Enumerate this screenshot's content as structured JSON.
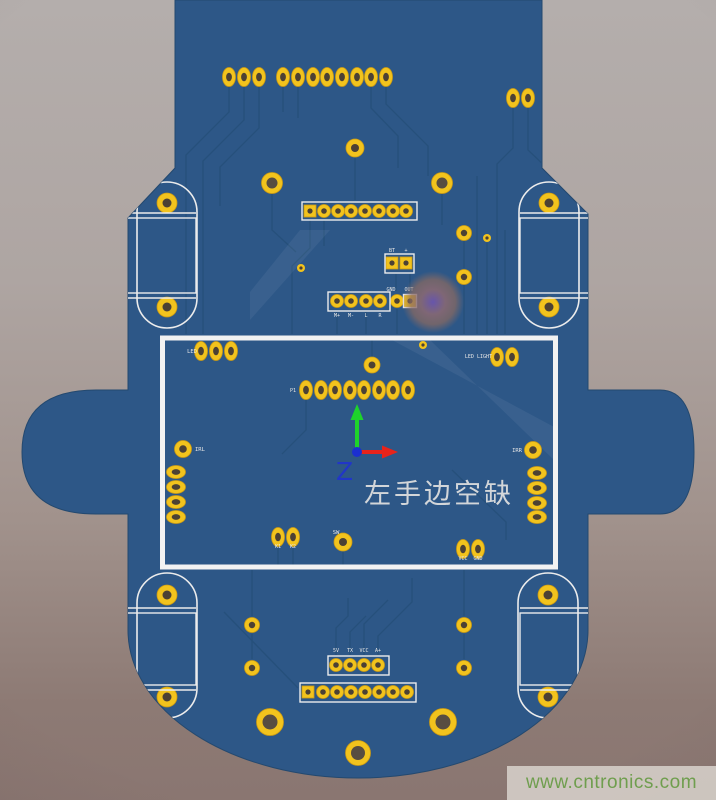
{
  "annotation": {
    "text": "左手边空缺",
    "color": "#d3d6d9"
  },
  "axis_gizmo": {
    "z_label": "Z",
    "axes": [
      {
        "name": "up-axis-green",
        "color": "#1ed32b"
      },
      {
        "name": "right-axis-red",
        "color": "#e8231a"
      },
      {
        "name": "z-origin-blue",
        "color": "#2136c8"
      }
    ]
  },
  "watermark": {
    "text": "www.cntronics.com",
    "text_color": "#6f9e4e",
    "background": "#d6d0c9"
  },
  "colors": {
    "board": "#2d5787",
    "board_edge": "#24496f",
    "trace": "#26507b",
    "pad": "#f2c31d",
    "pad_edge": "#cf9c12",
    "hole": "#4c4134",
    "hole_big": "#584d41",
    "silk": "#ececec",
    "highlight": "#f2f2f2",
    "blob_center": "#6a55ad",
    "blob_outer": "#8b6a61"
  },
  "silk_labels": [
    {
      "text": "LED",
      "x": 197,
      "y": 353,
      "anchor": "end",
      "size": 5.5
    },
    {
      "text": "LED LIGHT",
      "x": 492,
      "y": 358,
      "anchor": "end",
      "size": 5
    },
    {
      "text": "IRL",
      "x": 195,
      "y": 451,
      "anchor": "start",
      "size": 5.5
    },
    {
      "text": "IRR",
      "x": 522,
      "y": 452,
      "anchor": "end",
      "size": 5.5
    },
    {
      "text": "SW",
      "x": 336,
      "y": 534,
      "anchor": "middle",
      "size": 5.5
    },
    {
      "text": "GND",
      "x": 391,
      "y": 291,
      "anchor": "middle",
      "size": 5
    },
    {
      "text": "OUT",
      "x": 409,
      "y": 291,
      "anchor": "middle",
      "size": 5
    },
    {
      "text": "BT",
      "x": 392,
      "y": 252,
      "anchor": "middle",
      "size": 5
    },
    {
      "text": "+",
      "x": 406,
      "y": 252,
      "anchor": "middle",
      "size": 5
    },
    {
      "text": "M+",
      "x": 337,
      "y": 317,
      "anchor": "middle",
      "size": 5
    },
    {
      "text": "M-",
      "x": 351,
      "y": 317,
      "anchor": "middle",
      "size": 5
    },
    {
      "text": "L",
      "x": 366,
      "y": 317,
      "anchor": "middle",
      "size": 5
    },
    {
      "text": "R",
      "x": 380,
      "y": 317,
      "anchor": "middle",
      "size": 5
    },
    {
      "text": "5V",
      "x": 336,
      "y": 652,
      "anchor": "middle",
      "size": 5
    },
    {
      "text": "TX",
      "x": 350,
      "y": 652,
      "anchor": "middle",
      "size": 5
    },
    {
      "text": "VCC",
      "x": 364,
      "y": 652,
      "anchor": "middle",
      "size": 5
    },
    {
      "text": "A+",
      "x": 378,
      "y": 652,
      "anchor": "middle",
      "size": 5
    },
    {
      "text": "VCC",
      "x": 463,
      "y": 560,
      "anchor": "middle",
      "size": 5
    },
    {
      "text": "GND",
      "x": 478,
      "y": 560,
      "anchor": "middle",
      "size": 5
    },
    {
      "text": "K1",
      "x": 278,
      "y": 548,
      "anchor": "middle",
      "size": 5
    },
    {
      "text": "K2",
      "x": 293,
      "y": 548,
      "anchor": "middle",
      "size": 5
    },
    {
      "text": "P1",
      "x": 296,
      "y": 392,
      "anchor": "end",
      "size": 5
    }
  ],
  "graphics": {
    "traces": [
      "M229,86 L229,112 L186,155 L186,334",
      "M244,86 L244,120 L203,161 L203,334",
      "M259,86 L259,128 L220,167 L220,206",
      "M283,86 L283,112",
      "M298,86 L298,118",
      "M371,86 L371,108 L398,136 L398,168",
      "M386,86 L386,104 L428,146 L428,176",
      "M513,107 L513,148 L497,164 L497,334",
      "M528,107 L528,150 L549,170",
      "M560,8 L560,160",
      "M571,4 L571,148",
      "M355,158 L355,200",
      "M310,220 L310,248 L292,266 L292,334",
      "M324,220 L324,246",
      "M272,194 L272,230 L296,252",
      "M442,194 L442,225",
      "M396,274 L396,291",
      "M410,274 L410,291",
      "M337,312 L337,334",
      "M366,312 L366,334",
      "M397,309 L397,334",
      "M464,241 L464,268",
      "M464,285 L464,334",
      "M487,243 L487,334",
      "M477,176 L477,334",
      "M505,230 L505,334",
      "M306,399 L306,430 L282,454",
      "M372,357 L372,340",
      "M343,552 L343,566",
      "M278,547 L278,566",
      "M293,547 L293,566",
      "M452,470 L506,522 L506,540",
      "M336,655 L336,628 L348,616 L348,598",
      "M350,655 L350,632 L366,616",
      "M364,655 L364,624 L388,600",
      "M378,655 L378,636 L412,602 L412,578",
      "M252,570 L252,616",
      "M252,634 L252,659",
      "M464,570 L464,616",
      "M464,634 L464,659",
      "M224,612 L298,688"
    ],
    "light_bands": [
      "M392,340 L430,340 L556,462 L556,428 Z",
      "M300,230 L330,230 L250,320 L250,292 Z"
    ],
    "stadiums": [
      "M137,212 A30,30 0 0 1 197,212 L197,298 A30,30 0 0 1 137,298 Z",
      "M519,212 A30,30 0 0 1 579,212 L579,298 A30,30 0 0 1 519,298 Z",
      "M137,603 A30,30 0 0 1 197,603 L197,688 A30,30 0 0 1 137,688 Z",
      "M518,603 A30,30 0 0 1 578,603 L578,688 A30,30 0 0 1 518,688 Z"
    ],
    "white_outlines": [
      [
        125,
        218,
        71,
        75
      ],
      [
        520,
        218,
        71,
        75
      ],
      [
        125,
        613,
        71,
        72
      ],
      [
        520,
        613,
        71,
        72
      ],
      [
        302,
        202,
        115,
        18
      ],
      [
        385,
        254,
        29,
        19
      ],
      [
        328,
        292,
        62,
        19
      ],
      [
        403.5,
        294.5,
        13,
        13
      ],
      [
        328,
        656,
        61,
        19
      ],
      [
        300,
        683,
        116,
        19
      ]
    ],
    "white_lines": [
      [
        125,
        213,
        196,
        213
      ],
      [
        125,
        298,
        196,
        298
      ],
      [
        520,
        213,
        591,
        213
      ],
      [
        520,
        298,
        591,
        298
      ],
      [
        125,
        608,
        196,
        608
      ],
      [
        125,
        690,
        196,
        690
      ],
      [
        520,
        608,
        591,
        608
      ],
      [
        520,
        690,
        591,
        690
      ]
    ],
    "ring_pads": [
      [
        355,
        148,
        9,
        4
      ],
      [
        272,
        183,
        10.5,
        5.5
      ],
      [
        442,
        183,
        10.5,
        5.5
      ],
      [
        464,
        233,
        7.5,
        3.2
      ],
      [
        464,
        277,
        7.5,
        3.2
      ],
      [
        183,
        449,
        8.5,
        3.8
      ],
      [
        533,
        450,
        8.5,
        3.8
      ],
      [
        372,
        365,
        8,
        3.5
      ],
      [
        343,
        542,
        9,
        4
      ],
      [
        252,
        625,
        7.5,
        3.2
      ],
      [
        252,
        668,
        7.5,
        3.2
      ],
      [
        464,
        625,
        7.5,
        3.2
      ],
      [
        464,
        668,
        7.5,
        3.2
      ],
      [
        270,
        722,
        13.5,
        7.5
      ],
      [
        443,
        722,
        13.5,
        7.5
      ],
      [
        358,
        753,
        12.5,
        7
      ],
      [
        167,
        203,
        10,
        4.5
      ],
      [
        167,
        307,
        10,
        4.5
      ],
      [
        549,
        203,
        10,
        4.5
      ],
      [
        549,
        307,
        10,
        4.5
      ],
      [
        167,
        595,
        10,
        4.5
      ],
      [
        167,
        697,
        10,
        4.5
      ],
      [
        548,
        595,
        10,
        4.5
      ],
      [
        548,
        697,
        10,
        4.5
      ]
    ],
    "oval_pads_v": [
      [
        229,
        77
      ],
      [
        244,
        77
      ],
      [
        259,
        77
      ],
      [
        283,
        77
      ],
      [
        298,
        77
      ],
      [
        313,
        77
      ],
      [
        327,
        77
      ],
      [
        342,
        77
      ],
      [
        357,
        77
      ],
      [
        371,
        77
      ],
      [
        386,
        77
      ],
      [
        513,
        98
      ],
      [
        528,
        98
      ],
      [
        201,
        351
      ],
      [
        216,
        351
      ],
      [
        231,
        351
      ],
      [
        497,
        357
      ],
      [
        512,
        357
      ],
      [
        306,
        390
      ],
      [
        321,
        390
      ],
      [
        335,
        390
      ],
      [
        350,
        390
      ],
      [
        364,
        390
      ],
      [
        379,
        390
      ],
      [
        393,
        390
      ],
      [
        408,
        390
      ],
      [
        278,
        537
      ],
      [
        293,
        537
      ],
      [
        463,
        549
      ],
      [
        478,
        549
      ]
    ],
    "oval_pads_h": [
      [
        176,
        472
      ],
      [
        176,
        487
      ],
      [
        176,
        502
      ],
      [
        176,
        517
      ],
      [
        537,
        473
      ],
      [
        537,
        488
      ],
      [
        537,
        503
      ],
      [
        537,
        517
      ]
    ],
    "round_pins": [
      [
        324,
        211
      ],
      [
        338,
        211
      ],
      [
        351,
        211
      ],
      [
        365,
        211
      ],
      [
        379,
        211
      ],
      [
        393,
        211
      ],
      [
        406,
        211
      ],
      [
        337,
        301
      ],
      [
        351,
        301
      ],
      [
        366,
        301
      ],
      [
        380,
        301
      ],
      [
        397,
        301
      ],
      [
        336,
        665
      ],
      [
        350,
        665
      ],
      [
        364,
        665
      ],
      [
        378,
        665
      ],
      [
        323,
        692
      ],
      [
        337,
        692
      ],
      [
        351,
        692
      ],
      [
        365,
        692
      ],
      [
        379,
        692
      ],
      [
        393,
        692
      ],
      [
        407,
        692
      ]
    ],
    "square_pads": [
      [
        310,
        211
      ],
      [
        308,
        692
      ],
      [
        392,
        263
      ],
      [
        406,
        263
      ],
      [
        410,
        301
      ]
    ],
    "tiny_vias": [
      [
        301,
        268
      ],
      [
        487,
        238
      ],
      [
        423,
        345
      ]
    ]
  }
}
